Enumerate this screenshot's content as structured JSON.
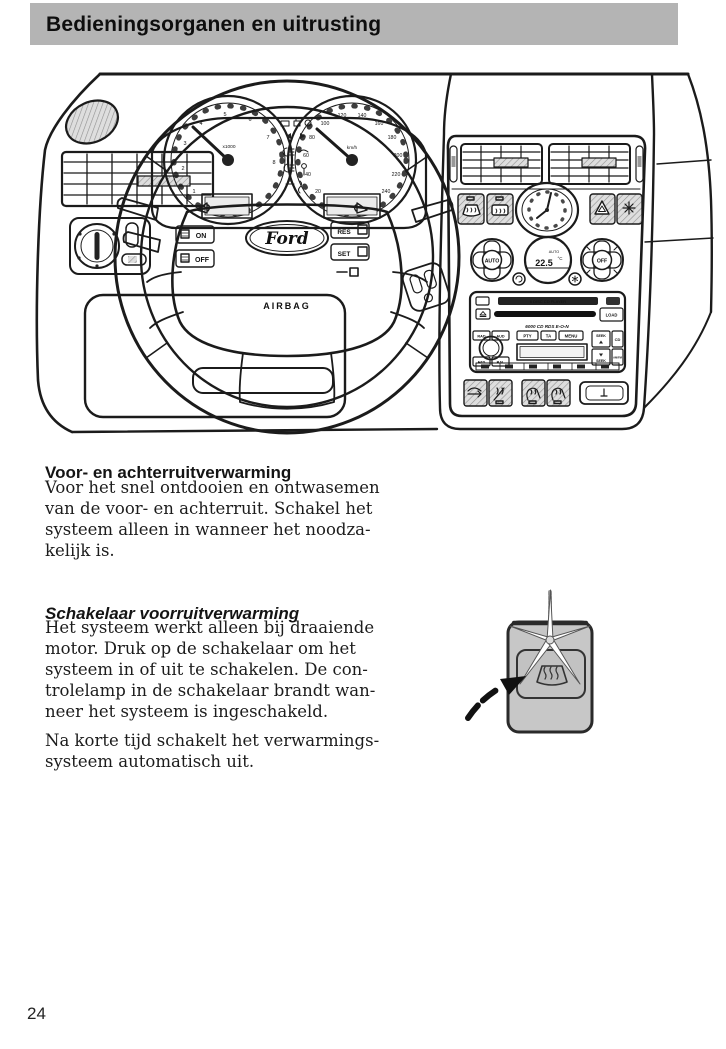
{
  "header": {
    "title": "Bedieningsorganen en uitrusting"
  },
  "footer": {
    "page_number": "24"
  },
  "content": {
    "sections": [
      {
        "heading": "Voor- en achterruitverwarming",
        "paragraphs": [
          {
            "lines": [
              "Voor het snel ontdooien en ontwasemen",
              "van de voor- en achterruit. Schakel het",
              "systeem alleen in wanneer het noodza-",
              "kelijk is."
            ]
          }
        ]
      },
      {
        "heading": "Schakelaar voorruitverwarming",
        "paragraphs": [
          {
            "lines": [
              "Het systeem werkt alleen bij draaiende",
              "motor. Druk op de schakelaar om het",
              "systeem in of uit te schakelen. De con-",
              "trolelamp in de schakelaar brandt wan-",
              "neer het systeem is ingeschakeld."
            ]
          },
          {
            "lines": [
              "Na korte tijd schakelt het verwarmings-",
              "systeem automatisch uit."
            ]
          }
        ]
      }
    ]
  },
  "dashboard": {
    "steering": {
      "brand_label": "Ford",
      "airbag_label": "AIRBAG"
    },
    "stalk_controls": {
      "on_label": "ON",
      "off_label": "OFF",
      "res_label": "RES",
      "set_label": "SET"
    },
    "cluster": {
      "tacho_multiplier_label": "x1000",
      "speed_unit_label": "km/h",
      "tacho_numbers": [
        "1",
        "2",
        "3",
        "4",
        "5",
        "6",
        "7",
        "8"
      ],
      "speedo_numbers": [
        "20",
        "40",
        "60",
        "80",
        "100",
        "120",
        "140",
        "160",
        "180",
        "200",
        "220",
        "240"
      ]
    },
    "console": {
      "climate": {
        "auto_knob_label": "AUTO",
        "off_knob_label": "OFF",
        "temperature_value": "22.5",
        "temperature_unit": "°C",
        "display_mode_label": "AUTO"
      },
      "radio": {
        "cd_slot_label": "6 DISC CD PLAYER",
        "model_label": "6000 CD RDS E-O-N",
        "load_label": "LOAD",
        "pty_label": "PTY",
        "ta_label": "TA",
        "menu_label": "MENU",
        "seek_label": "SEEK",
        "cd_label": "CD",
        "amfm_label": "AM/FM",
        "rad_label": "RAD",
        "aud_label": "AUD",
        "fad_label": "FAD",
        "bal_label": "BAL"
      }
    }
  },
  "colors": {
    "header_bar": "#b4b4b4",
    "line_ink": "#1b1b1b",
    "switch_gray": "#c8c8c8"
  }
}
